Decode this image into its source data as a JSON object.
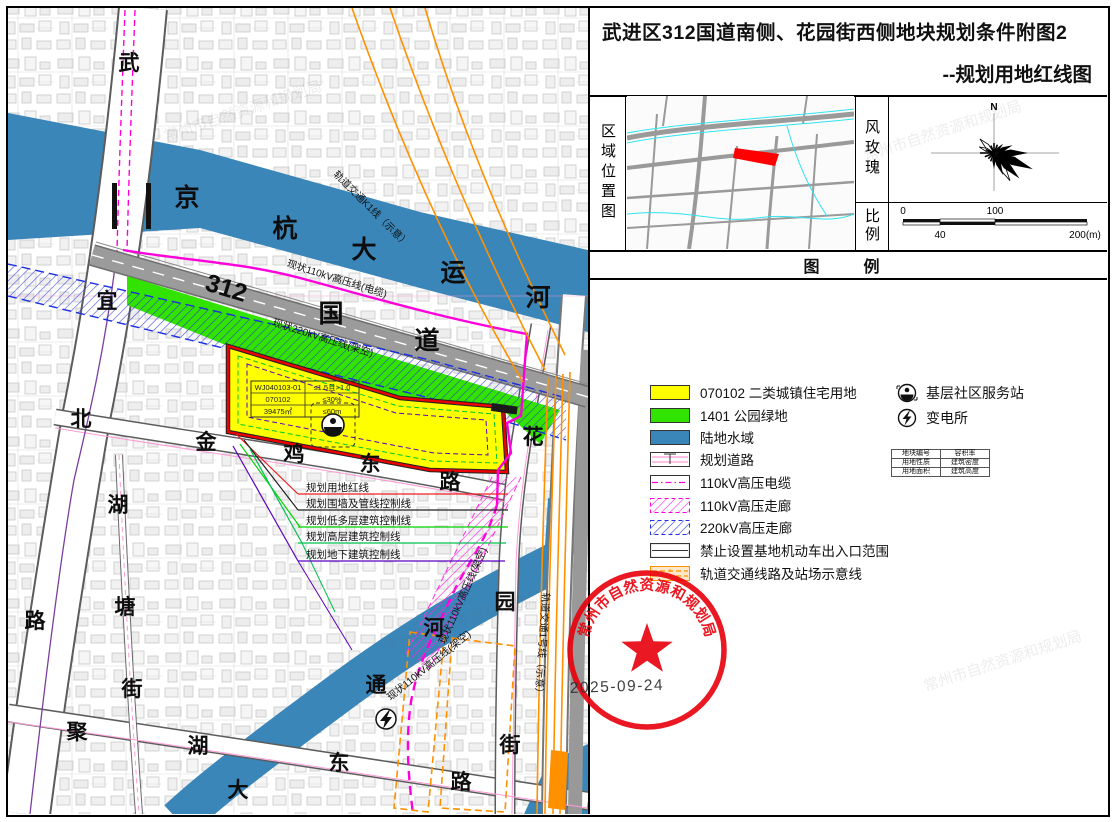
{
  "title": {
    "line1": "武进区312国道南侧、花园街西侧地块规划条件附图2",
    "line2": "--规划用地红线图"
  },
  "panels": {
    "region_map_label": "区域位置图",
    "wind_rose_label": "风玫瑰",
    "scale_label": "比例",
    "legend_header": "图　例",
    "north_label": "N"
  },
  "scale_bar": {
    "tick0": "0",
    "tick40": "40",
    "tick100": "100",
    "tick200": "200(m)"
  },
  "legend": {
    "items": [
      {
        "label": "070102 二类城镇住宅用地",
        "swatch_color": "#ffff00"
      },
      {
        "label": "1401 公园绿地",
        "swatch_color": "#33e300"
      },
      {
        "label": "陆地水域",
        "swatch_color": "#3a86b9"
      },
      {
        "label": "规划道路",
        "swatch_color": "#ffffff"
      },
      {
        "label": "110kV高压电缆",
        "swatch_color": "#ff00dc"
      },
      {
        "label": "110kV高压走廊",
        "swatch_color": "#ff00dc"
      },
      {
        "label": "220kV高压走廊",
        "swatch_color": "#2233dd"
      },
      {
        "label": "禁止设置基地机动车出入口范围",
        "swatch_color": "#ffffff"
      },
      {
        "label": "轨道交通线路及站场示意线",
        "swatch_color": "#ff9100"
      }
    ],
    "point_items": [
      {
        "label": "基层社区服务站",
        "icon": "community-station-icon"
      },
      {
        "label": "变电所",
        "icon": "substation-icon"
      }
    ],
    "info_table": {
      "rows": [
        [
          "地块编号",
          "容积率"
        ],
        [
          "用地性质",
          "建筑密度"
        ],
        [
          "用地面积",
          "建筑高度"
        ]
      ]
    }
  },
  "parcel_table": {
    "rows": [
      [
        "WJ040103-01",
        "≤1.5且>1.0"
      ],
      [
        "070102",
        "≤30%"
      ],
      [
        "39475㎡",
        "≤60m"
      ]
    ]
  },
  "map_labels": {
    "canal": [
      "京",
      "杭",
      "大",
      "运",
      "河"
    ],
    "g312": [
      "312",
      "国",
      "道"
    ],
    "wuyi_road": [
      "武",
      "宜",
      "北",
      "路"
    ],
    "jinji_road": [
      "金",
      "鸡",
      "东",
      "路"
    ],
    "hutang_street": [
      "湖",
      "塘",
      "街"
    ],
    "juhu_road": [
      "聚",
      "湖",
      "东",
      "路"
    ],
    "datong_river": [
      "河",
      "通",
      "大"
    ],
    "huayuan_street": [
      "花",
      "园",
      "街"
    ],
    "line110_cable": "现状110kV高压线(电缆)",
    "line220_overhead": "现状220kV高压线(架空)",
    "line110_overhead_a": "现状110kV高压线(架空)",
    "line110_overhead_b": "现状110kV高压线(架空)",
    "rail_k1": "轨道交通K1线（示意）",
    "rail_line1": "轨道交通1号线（示意）",
    "leaders": [
      "规划用地红线",
      "规划围墙及管线控制线",
      "规划低多层建筑控制线",
      "规划高层建筑控制线",
      "规划地下建筑控制线"
    ]
  },
  "stamp": {
    "org": "常州市自然资源和规划局",
    "date": "2025-09-24"
  },
  "watermark": "常州市自然资源和规划局",
  "colors": {
    "residential": "#ffff00",
    "park_green": "#33e300",
    "water": "#3a86b9",
    "red_line": "#ec0000",
    "magenta_power": "#ff00dc",
    "corridor220": "#2233dd",
    "rail_orange": "#ff9100",
    "underground_purple": "#5b00c0",
    "stamp_red": "#e8000b"
  }
}
